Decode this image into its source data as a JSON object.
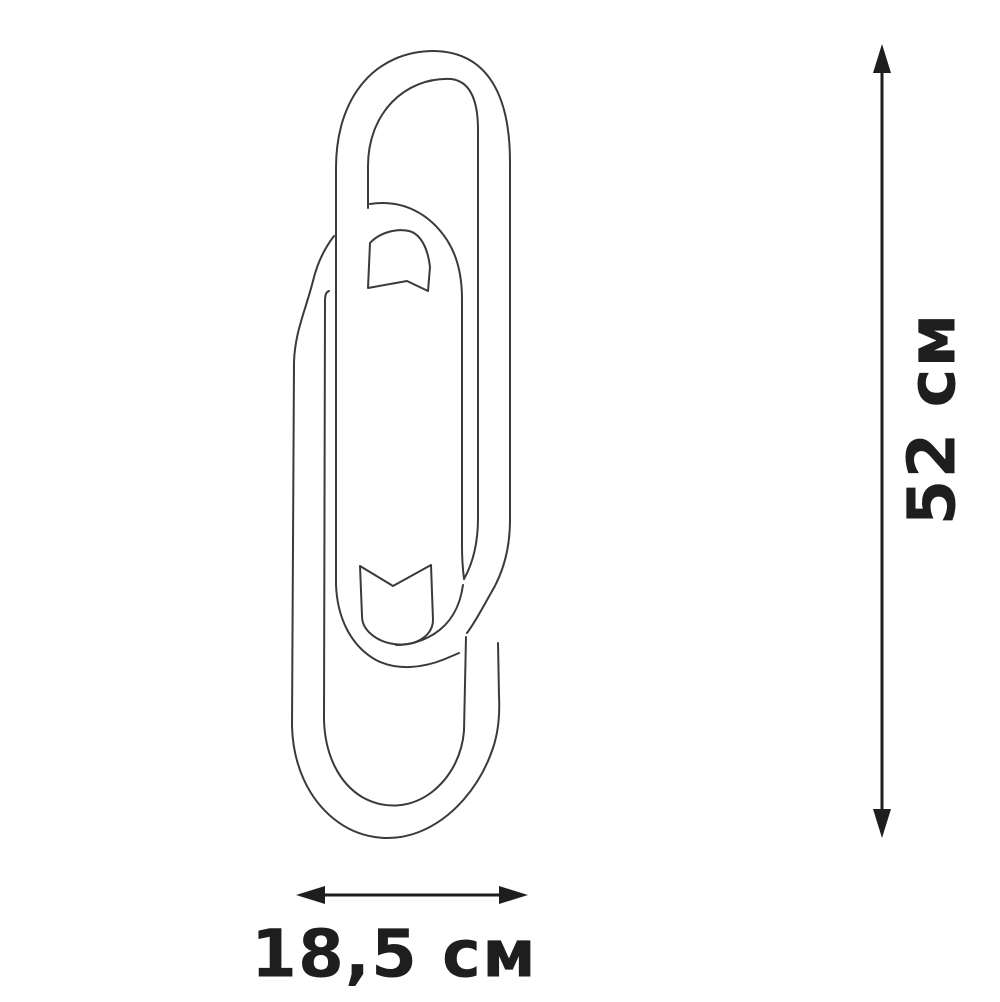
{
  "diagram": {
    "description": "Dimensional line drawing of a paperclip-shaped wall lamp (two interlocked oval tube loops) with overall size arrows",
    "height_dimension": {
      "label": "52 см",
      "value": "52",
      "unit": "см"
    },
    "width_dimension": {
      "label": "18,5 см",
      "value": "18,5",
      "unit": "см"
    },
    "colors": {
      "background": "#ffffff",
      "outline": "#3a3a3a",
      "dimension": "#1e1e1e"
    }
  }
}
